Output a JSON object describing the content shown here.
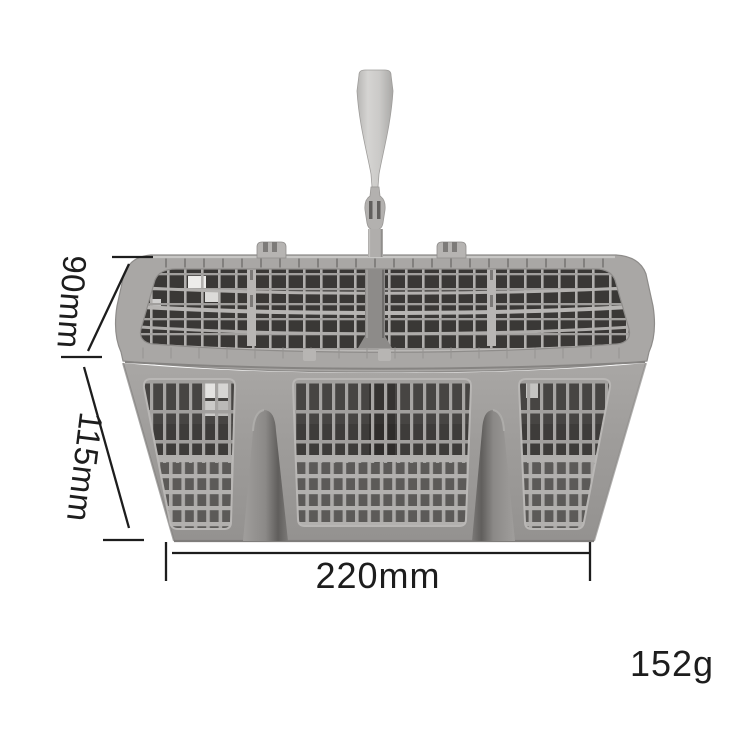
{
  "subject": "grey dishwasher cutlery basket with carry handle",
  "annotations": {
    "rim_height": "90mm",
    "body_height": "115mm",
    "width": "220mm",
    "weight": "152g"
  },
  "palette": {
    "background": "#ffffff",
    "annotation_ink": "#1d1d1d",
    "basket_highlight": "#d5d4d2",
    "basket_mid_grey": "#a9a7a5",
    "basket_dark_interior": "#3a3836"
  }
}
